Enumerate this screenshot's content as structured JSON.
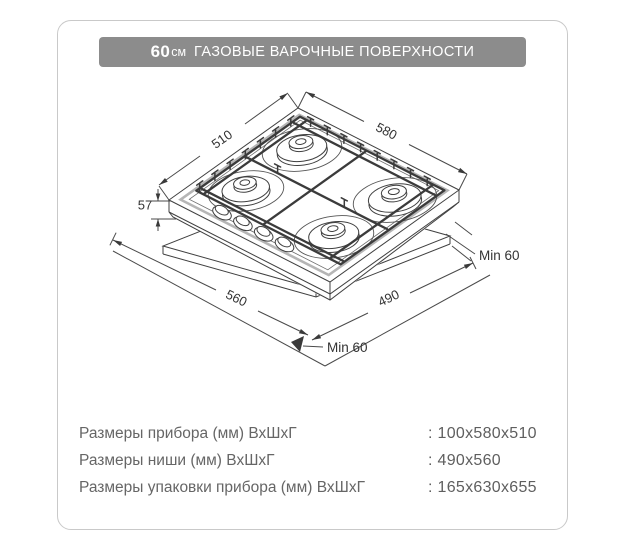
{
  "header": {
    "size": "60",
    "unit": "см",
    "title": "ГАЗОВЫЕ ВАРОЧНЫЕ ПОВЕРХНОСТИ"
  },
  "diagram": {
    "labels": {
      "top_depth": "510",
      "top_width": "580",
      "body_height": "57",
      "niche_width": "560",
      "niche_depth": "490",
      "min_clearance_right": "Min 60",
      "min_clearance_bottom": "Min 60"
    }
  },
  "specs": {
    "rows": [
      {
        "label": "Размеры прибора (мм) ВхШхГ",
        "value": ": 100x580x510"
      },
      {
        "label": "Размеры ниши (мм) ВхШхГ",
        "value": ": 490x560"
      },
      {
        "label": "Размеры упаковки прибора (мм) ВхШхГ",
        "value": ": 165x630x655"
      }
    ]
  },
  "colors": {
    "header_bg": "#8c8c8c",
    "card_border": "#c9c9c9",
    "line": "#404040",
    "text": "#666666"
  }
}
